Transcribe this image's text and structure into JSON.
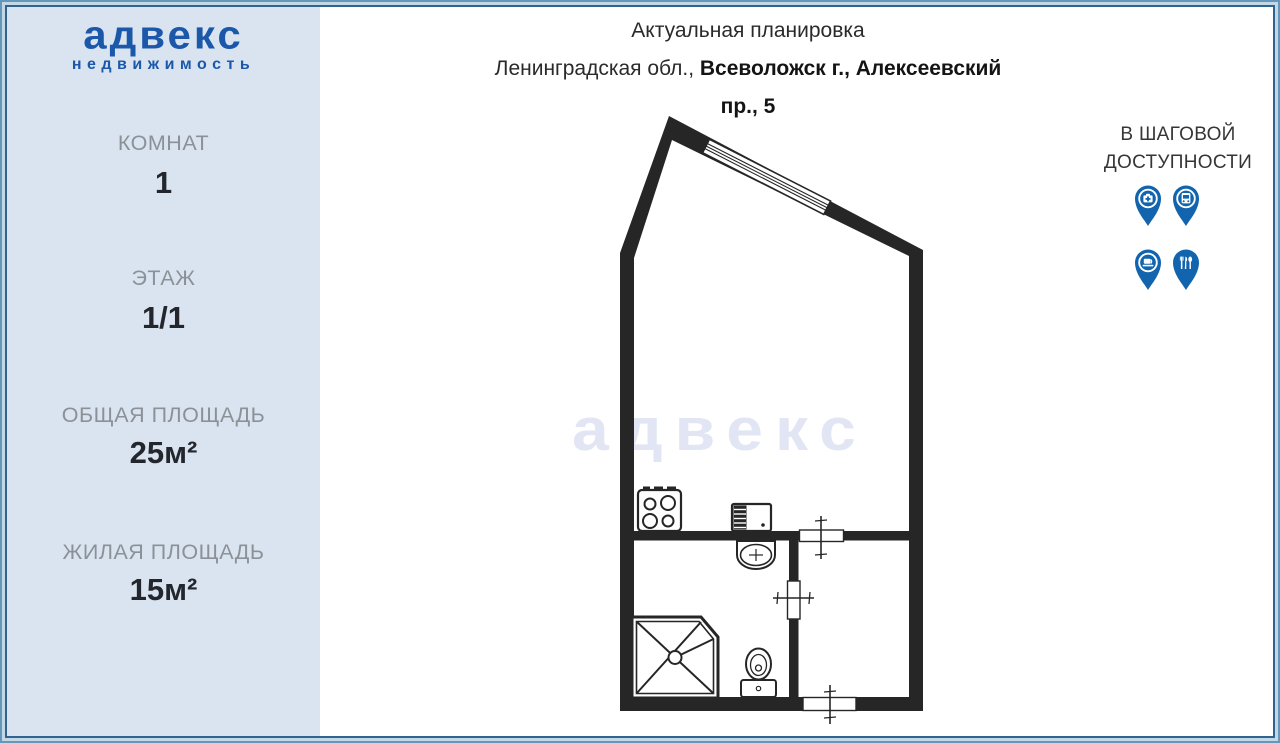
{
  "sidebar": {
    "logo": {
      "title": "адвекс",
      "subtitle": "недвижимость"
    },
    "stats": [
      {
        "label": "КОМНАТ",
        "value": "1"
      },
      {
        "label": "ЭТАЖ",
        "value": "1/1"
      },
      {
        "label": "ОБЩАЯ ПЛОЩАДЬ",
        "value": "25м²"
      },
      {
        "label": "ЖИЛАЯ ПЛОЩАДЬ",
        "value": "15м²"
      }
    ]
  },
  "header": {
    "title": "Актуальная планировка",
    "address_prefix": "Ленинградская обл., ",
    "address_bold": "Всеволожск г., Алексеевский",
    "address_line2": "пр., 5"
  },
  "walkability": {
    "line1": "В ШАГОВОЙ",
    "line2": "ДОСТУПНОСТИ",
    "icons": [
      {
        "name": "pharmacy-pin-icon"
      },
      {
        "name": "bus-pin-icon"
      },
      {
        "name": "cafe-pin-icon"
      },
      {
        "name": "restaurant-pin-icon"
      }
    ]
  },
  "watermark": {
    "text": "адвекс"
  },
  "floor_plan": {
    "rooms": [
      "main room",
      "bathroom with shower, basin and toilet",
      "entrance hall"
    ],
    "fixtures": [
      "stove",
      "kitchen-sink",
      "wash-basin",
      "shower-cabin",
      "toilet"
    ],
    "doors": 3,
    "windows": 1
  },
  "colors": {
    "logo_blue": "#1b58aa",
    "pin_blue": "#1164ad",
    "sidebar_bg": "#d9e4f0",
    "wall": "#262626",
    "watermark": "#e1e5f4",
    "frame_dark": "#2e6590",
    "frame_light": "#c3d7e5",
    "frame_steel": "#6397bc",
    "label_gray": "#8c9198",
    "value_dark": "#23262c"
  }
}
